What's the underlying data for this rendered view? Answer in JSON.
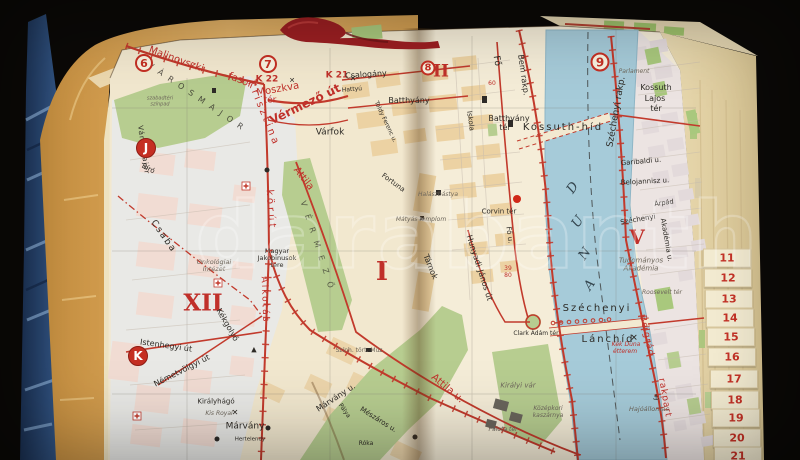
{
  "palette": {
    "red": "#c0302a",
    "ink": "#2e2b26",
    "gray": "#6e675c",
    "river_ink": "#34454e"
  },
  "scene": {
    "watermark": "darabanth"
  },
  "tabs": {
    "items": [
      {
        "t": "11",
        "x": 703,
        "y": 258
      },
      {
        "t": "12",
        "x": 704,
        "y": 278
      },
      {
        "t": "13",
        "x": 705,
        "y": 299
      },
      {
        "t": "14",
        "x": 706,
        "y": 318
      },
      {
        "t": "15",
        "x": 707,
        "y": 337
      },
      {
        "t": "16",
        "x": 708,
        "y": 357
      },
      {
        "t": "17",
        "x": 710,
        "y": 379
      },
      {
        "t": "18",
        "x": 711,
        "y": 400
      },
      {
        "t": "19",
        "x": 712,
        "y": 418
      },
      {
        "t": "20",
        "x": 713,
        "y": 438
      },
      {
        "t": "21",
        "x": 714,
        "y": 456
      }
    ]
  },
  "map": {
    "markers": [
      {
        "t": "6",
        "x": 144,
        "y": 63,
        "d": 18,
        "k": "ring",
        "fs": 11
      },
      {
        "t": "7",
        "x": 268,
        "y": 64,
        "d": 18,
        "k": "ring",
        "fs": 11
      },
      {
        "t": "8",
        "x": 428,
        "y": 68,
        "d": 15,
        "k": "ring",
        "fs": 10
      },
      {
        "t": "9",
        "x": 600,
        "y": 62,
        "d": 19,
        "k": "ring",
        "fs": 12
      },
      {
        "t": "J",
        "x": 146,
        "y": 148,
        "d": 20,
        "k": "solid",
        "fs": 12
      },
      {
        "t": "K",
        "x": 138,
        "y": 356,
        "d": 20,
        "k": "solid",
        "fs": 12
      }
    ],
    "labels": [
      {
        "t": "Malinovszki",
        "x": 176,
        "y": 60,
        "r": 20,
        "fs": 10,
        "c": "red"
      },
      {
        "t": "fasor",
        "x": 240,
        "y": 81,
        "r": 22,
        "fs": 10,
        "c": "red"
      },
      {
        "t": "K 22",
        "x": 267,
        "y": 80,
        "fs": 9,
        "b": 1,
        "c": "red"
      },
      {
        "t": "✕",
        "x": 292,
        "y": 81,
        "fs": 7
      },
      {
        "t": "K 21",
        "x": 337,
        "y": 76,
        "fs": 9,
        "b": 1,
        "c": "red"
      },
      {
        "t": "✕",
        "x": 353,
        "y": 79,
        "fs": 8
      },
      {
        "t": "Moszkva",
        "x": 278,
        "y": 90,
        "r": -10,
        "fs": 10,
        "c": "red"
      },
      {
        "t": "tér",
        "x": 270,
        "y": 101,
        "fs": 9,
        "c": "red"
      },
      {
        "t": "Vérmező út",
        "x": 305,
        "y": 104,
        "r": -26,
        "fs": 12,
        "b": 1,
        "c": "red"
      },
      {
        "t": "Krisztina",
        "x": 263,
        "y": 114,
        "r": 68,
        "fs": 10,
        "ls": 3,
        "c": "red"
      },
      {
        "t": "körút",
        "x": 270,
        "y": 210,
        "r": 86,
        "fs": 10,
        "ls": 3,
        "c": "red"
      },
      {
        "t": "Attila",
        "x": 303,
        "y": 179,
        "r": 52,
        "fs": 10,
        "c": "red"
      },
      {
        "t": "Attila u.",
        "x": 447,
        "y": 389,
        "r": 40,
        "fs": 10,
        "c": "red"
      },
      {
        "t": "Alkotás",
        "x": 264,
        "y": 300,
        "r": 88,
        "fs": 9,
        "ls": 2,
        "c": "red"
      },
      {
        "t": "Belgrád",
        "x": 646,
        "y": 336,
        "r": 78,
        "fs": 9,
        "ls": 1,
        "c": "red"
      },
      {
        "t": "rakpart",
        "x": 664,
        "y": 398,
        "r": 80,
        "fs": 9,
        "ls": 1,
        "c": "red"
      },
      {
        "t": "Kék Duna",
        "x": 626,
        "y": 345,
        "fs": 6,
        "it": 1,
        "c": "red"
      },
      {
        "t": "étterem",
        "x": 625,
        "y": 352,
        "fs": 6,
        "it": 1,
        "c": "red"
      },
      {
        "t": "39",
        "x": 508,
        "y": 269,
        "fs": 6,
        "c": "red"
      },
      {
        "t": "80",
        "x": 508,
        "y": 276,
        "fs": 6,
        "c": "red"
      },
      {
        "t": "60",
        "x": 492,
        "y": 84,
        "fs": 6,
        "c": "red"
      },
      {
        "t": "XII",
        "x": 203,
        "y": 303,
        "fs": 23,
        "b": 1,
        "serif": 1,
        "c": "red"
      },
      {
        "t": "I",
        "x": 382,
        "y": 272,
        "fs": 26,
        "b": 1,
        "serif": 1,
        "c": "red"
      },
      {
        "t": "II",
        "x": 441,
        "y": 72,
        "fs": 17,
        "b": 1,
        "serif": 1,
        "c": "red"
      },
      {
        "t": "V",
        "x": 637,
        "y": 237,
        "fs": 20,
        "b": 1,
        "serif": 1,
        "c": "red"
      },
      {
        "t": "V Á R O S M A J O R",
        "x": 196,
        "y": 97,
        "r": 34,
        "fs": 8,
        "ls": 2,
        "o": 0.8
      },
      {
        "t": "szabadtéri",
        "x": 160,
        "y": 99,
        "fs": 5,
        "it": 1,
        "c": "gray"
      },
      {
        "t": "színpad",
        "x": 160,
        "y": 105,
        "fs": 5,
        "it": 1,
        "c": "gray"
      },
      {
        "t": "Városmajor",
        "x": 143,
        "y": 150,
        "r": 82,
        "fs": 7,
        "ls": 1
      },
      {
        "t": "Bíró",
        "x": 148,
        "y": 169,
        "r": 28,
        "fs": 7
      },
      {
        "t": "Csaba",
        "x": 163,
        "y": 237,
        "r": 55,
        "fs": 9,
        "ls": 2
      },
      {
        "t": "Kékgolyó",
        "x": 227,
        "y": 325,
        "r": 60,
        "fs": 8
      },
      {
        "t": "Istenhegyi út",
        "x": 166,
        "y": 346,
        "r": 8,
        "fs": 8
      },
      {
        "t": "Németvölgyi út",
        "x": 182,
        "y": 371,
        "r": -27,
        "fs": 8
      },
      {
        "t": "Királyhágó",
        "x": 216,
        "y": 402,
        "fs": 7
      },
      {
        "t": "Márvány",
        "x": 245,
        "y": 427,
        "fs": 9
      },
      {
        "t": "Márvány u.",
        "x": 336,
        "y": 398,
        "r": -33,
        "fs": 8
      },
      {
        "t": "Hertelendy",
        "x": 250,
        "y": 440,
        "fs": 5.5
      },
      {
        "t": "Mészáros u.",
        "x": 378,
        "y": 420,
        "r": 32,
        "fs": 7
      },
      {
        "t": "Pálya",
        "x": 344,
        "y": 411,
        "r": 55,
        "fs": 6
      },
      {
        "t": "Róka",
        "x": 366,
        "y": 444,
        "fs": 6
      },
      {
        "t": "Kis Royal",
        "x": 219,
        "y": 414,
        "fs": 6,
        "it": 1,
        "c": "gray"
      },
      {
        "t": "✕",
        "x": 235,
        "y": 413,
        "fs": 8
      },
      {
        "t": "▲",
        "x": 254,
        "y": 350,
        "fs": 7
      },
      {
        "t": "Onkológiai",
        "x": 214,
        "y": 262,
        "fs": 6.5,
        "it": 1,
        "c": "gray"
      },
      {
        "t": "Intézet",
        "x": 214,
        "y": 269,
        "fs": 6.5,
        "it": 1,
        "c": "gray"
      },
      {
        "t": "Magyar",
        "x": 277,
        "y": 251,
        "fs": 6.5
      },
      {
        "t": "Jakobinusok",
        "x": 277,
        "y": 258,
        "fs": 6.5
      },
      {
        "t": "tere",
        "x": 277,
        "y": 265,
        "fs": 6.5
      },
      {
        "t": "V É R M E Z Ő",
        "x": 317,
        "y": 246,
        "r": 72,
        "fs": 8,
        "ls": 3,
        "o": 0.7
      },
      {
        "t": "Csalogány",
        "x": 366,
        "y": 75,
        "r": -4,
        "fs": 8
      },
      {
        "t": "Hattyú",
        "x": 352,
        "y": 90,
        "r": -5,
        "fs": 6
      },
      {
        "t": "Batthyány",
        "x": 409,
        "y": 101,
        "fs": 8
      },
      {
        "t": "Várfok",
        "x": 330,
        "y": 133,
        "fs": 9
      },
      {
        "t": "Toldy Ferenc u.",
        "x": 385,
        "y": 122,
        "r": 65,
        "fs": 6
      },
      {
        "t": "Iskola",
        "x": 470,
        "y": 121,
        "r": 82,
        "fs": 7
      },
      {
        "t": "Fő",
        "x": 496,
        "y": 61,
        "r": 80,
        "fs": 9
      },
      {
        "t": "Bem rakp.",
        "x": 523,
        "y": 75,
        "r": 82,
        "fs": 8
      },
      {
        "t": "Batthyány",
        "x": 509,
        "y": 119,
        "fs": 8
      },
      {
        "t": "tér",
        "x": 505,
        "y": 128,
        "fs": 8
      },
      {
        "t": "Kossuth-híd",
        "x": 563,
        "y": 128,
        "fs": 10,
        "ls": 2
      },
      {
        "t": "Széchenyi rakp.",
        "x": 617,
        "y": 112,
        "r": -80,
        "fs": 9
      },
      {
        "t": "Parlament",
        "x": 634,
        "y": 72,
        "fs": 6,
        "it": 1,
        "c": "gray"
      },
      {
        "t": "Kossuth",
        "x": 656,
        "y": 88,
        "fs": 8
      },
      {
        "t": "Lajos",
        "x": 655,
        "y": 99,
        "fs": 8
      },
      {
        "t": "tér",
        "x": 656,
        "y": 109,
        "fs": 8
      },
      {
        "t": "Garibaldi u.",
        "x": 641,
        "y": 162,
        "r": -5,
        "fs": 7
      },
      {
        "t": "Belojannisz u.",
        "x": 645,
        "y": 182,
        "r": -3,
        "fs": 7
      },
      {
        "t": "Árpád",
        "x": 664,
        "y": 203,
        "r": -8,
        "fs": 6.5
      },
      {
        "t": "Széchenyi",
        "x": 638,
        "y": 220,
        "r": -10,
        "fs": 7
      },
      {
        "t": "Akadémia u.",
        "x": 666,
        "y": 240,
        "r": 80,
        "fs": 7
      },
      {
        "t": "Tudományos",
        "x": 641,
        "y": 261,
        "fs": 7,
        "it": 1,
        "c": "gray"
      },
      {
        "t": "Akadémia",
        "x": 641,
        "y": 269,
        "fs": 7,
        "it": 1,
        "c": "gray"
      },
      {
        "t": "Roosevelt tér",
        "x": 662,
        "y": 293,
        "fs": 6,
        "it": 1,
        "c": "gray"
      },
      {
        "t": "Fortuna",
        "x": 393,
        "y": 183,
        "r": 36,
        "fs": 7
      },
      {
        "t": "Halászbástya",
        "x": 438,
        "y": 195,
        "fs": 6,
        "it": 1,
        "c": "gray"
      },
      {
        "t": "Mátyás templom",
        "x": 421,
        "y": 220,
        "fs": 6,
        "it": 1,
        "c": "gray"
      },
      {
        "t": "Corvin tér",
        "x": 499,
        "y": 212,
        "fs": 7
      },
      {
        "t": "Fő u.",
        "x": 509,
        "y": 235,
        "r": 82,
        "fs": 7
      },
      {
        "t": "Hunyadi-János út",
        "x": 479,
        "y": 268,
        "r": 72,
        "fs": 8
      },
      {
        "t": "Tárnok",
        "x": 430,
        "y": 267,
        "r": 68,
        "fs": 8
      },
      {
        "t": "Szính. tört. Múz.",
        "x": 360,
        "y": 351,
        "fs": 6,
        "c": "gray"
      },
      {
        "t": "Királyi vár",
        "x": 518,
        "y": 386,
        "fs": 7,
        "it": 1,
        "c": "gray"
      },
      {
        "t": "Középkori",
        "x": 548,
        "y": 409,
        "fs": 6,
        "it": 1,
        "c": "gray"
      },
      {
        "t": "kaszárnya",
        "x": 548,
        "y": 416,
        "fs": 6,
        "it": 1,
        "c": "gray"
      },
      {
        "t": "Clark Ádám tér",
        "x": 536,
        "y": 334,
        "fs": 6
      },
      {
        "t": "Palota tér",
        "x": 503,
        "y": 430,
        "fs": 6,
        "it": 1,
        "c": "gray"
      },
      {
        "t": "Széchenyi",
        "x": 597,
        "y": 309,
        "fs": 10,
        "ls": 2
      },
      {
        "t": "Lánchíd",
        "x": 608,
        "y": 340,
        "fs": 10,
        "ls": 2
      },
      {
        "t": "✕",
        "x": 634,
        "y": 339,
        "fs": 9
      },
      {
        "t": "Hajóállomás",
        "x": 649,
        "y": 409,
        "fs": 6.5,
        "it": 1,
        "c": "gray"
      },
      {
        "t": "⚓",
        "x": 656,
        "y": 398,
        "fs": 8
      },
      {
        "t": "D",
        "x": 573,
        "y": 188,
        "r": -55,
        "fs": 13,
        "it": 1,
        "serif": 1,
        "c": "river_ink"
      },
      {
        "t": "U",
        "x": 578,
        "y": 222,
        "r": -55,
        "fs": 13,
        "it": 1,
        "serif": 1,
        "c": "river_ink"
      },
      {
        "t": "N",
        "x": 585,
        "y": 254,
        "r": -55,
        "fs": 13,
        "it": 1,
        "serif": 1,
        "c": "river_ink"
      },
      {
        "t": "A",
        "x": 590,
        "y": 285,
        "r": -55,
        "fs": 13,
        "it": 1,
        "serif": 1,
        "c": "river_ink"
      }
    ]
  }
}
